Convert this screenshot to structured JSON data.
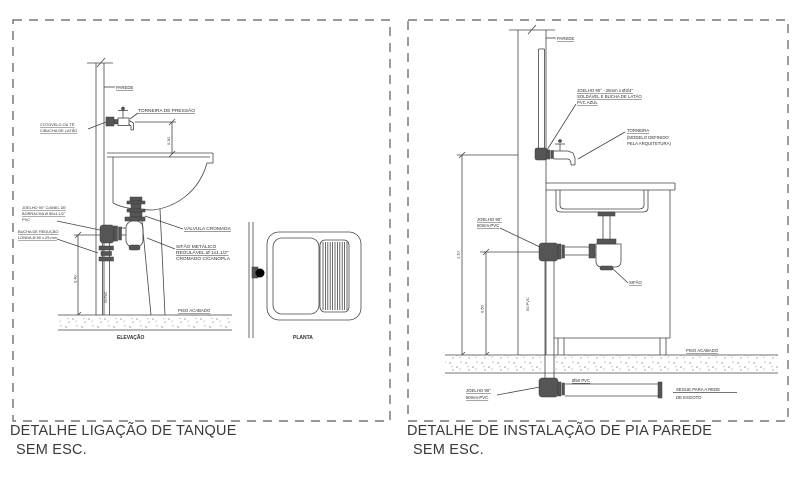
{
  "page": {
    "background": "#ffffff",
    "line_color": "#454545",
    "text_color": "#2e2e2e"
  },
  "left_panel": {
    "caption": "DETALHE LIGAÇÃO DE TANQUE",
    "scale_note": "SEM ESC.",
    "elevation": {
      "view_label": "ELEVAÇÃO",
      "wall_label": "PAREDE",
      "faucet_label": "TORNEIRA DE PRESSÃO",
      "elbow_label_line1": "COTOVELO OU TÊ",
      "elbow_label_line2": "C/BUCHA DE LATÃO",
      "faucet_height_dim": "0.30",
      "drain_elbow_label_line1": "JOELHO 90° C/ANEL DE",
      "drain_elbow_label_line2": "BORRACHA Ø 50x1.1/2\"",
      "drain_elbow_label_line3": "PVC",
      "bushing_label_line1": "BUCHA DE REDUÇÃO",
      "bushing_label_line2": "LONGA Ø 50 x 25 mm",
      "valve_label": "VÁLVULA CROMADA",
      "trap_label_line1": "SIFÃO METÁLICO",
      "trap_label_line2": "REGULÁVEL Ø 1x1.1/2\"",
      "trap_label_line3": "CROMADO C/CANOPLA",
      "riser_pipe_label": "50 PVC",
      "riser_height_dim": "0.40",
      "floor_label": "PISO ACABADO"
    },
    "plan": {
      "view_label": "PLANTA"
    }
  },
  "right_panel": {
    "caption": "DETALHE DE INSTALAÇÃO DE PIA PAREDE",
    "scale_note": "SEM ESC.",
    "wall_label": "PAREDE",
    "water_elbow_label_line1": "JOELHO 90° - 25mm x Ø3/4\"",
    "water_elbow_label_line2": "SOLDÁVEL E BUCHA DE LATÃO",
    "water_elbow_label_line3": "PVC AZUL",
    "faucet_label_line1": "TORNEIRA",
    "faucet_label_line2": "(MODELO DEFINIDO",
    "faucet_label_line3": "PELA ARQUITETURA)",
    "drain_elbow_upper_line1": "JOELHO 90°",
    "drain_elbow_upper_line2": "50mm-PVC",
    "trap_label": "SIFÃO",
    "riser_pipe_label": "50 PVC",
    "total_height_dim": "1.10",
    "drain_height_dim": "0.50",
    "floor_label": "PISO ACABADO",
    "drain_elbow_lower_line1": "JOELHO 90°",
    "drain_elbow_lower_line2": "50mm-PVC",
    "sewer_pipe_label": "Ø50 PVC",
    "sewer_note_line1": "SEGUE PARA A REDE",
    "sewer_note_line2": "DE ESGOTO"
  }
}
